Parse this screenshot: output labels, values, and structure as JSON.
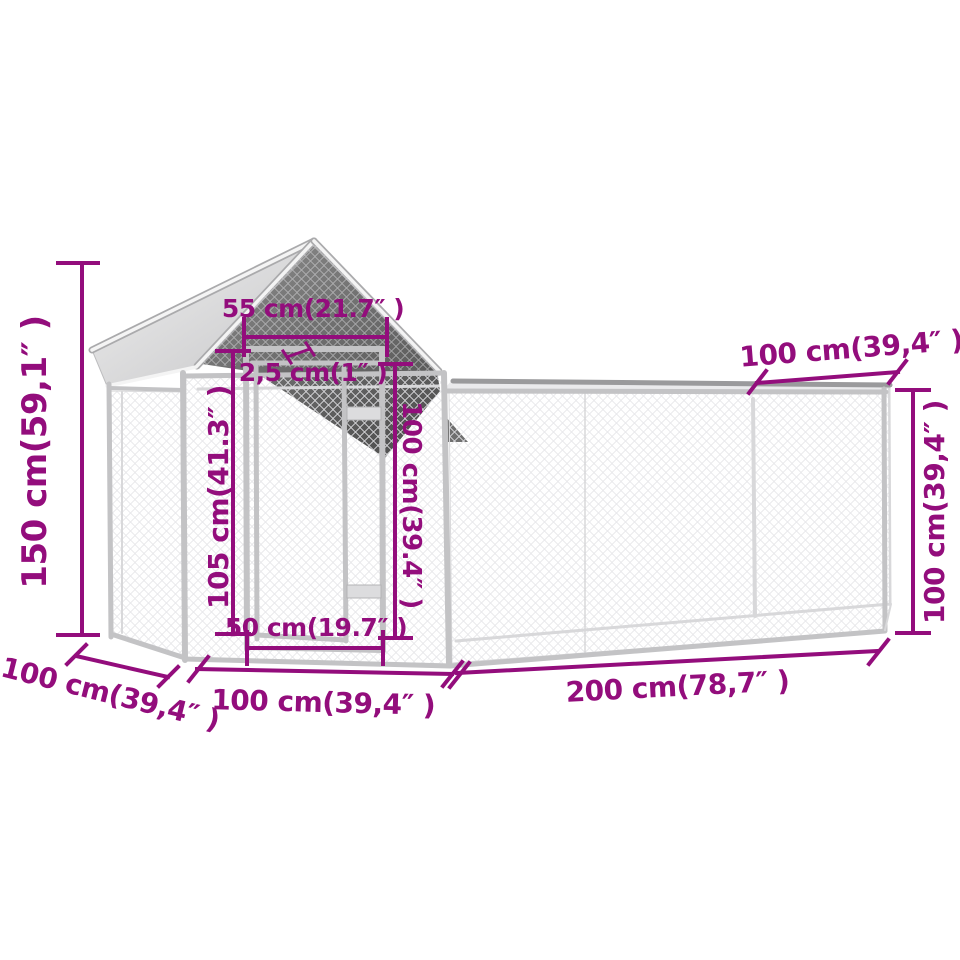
{
  "diagram": {
    "title": "chicken-coop-with-run-dimension-diagram",
    "accent_color": "#930d7c",
    "background": "#ffffff"
  },
  "dimensions": {
    "total_height": {
      "label": "150 cm(59,1″ )"
    },
    "coop_roof_width": {
      "label": "55 cm(21.7″ )"
    },
    "frame_tube": {
      "label": "2,5 cm(1″ )"
    },
    "door_height": {
      "label": "105 cm(41.3″ )"
    },
    "wall_height": {
      "label": "100 cm(39.4″ )"
    },
    "door_width": {
      "label": "50 cm(19.7″ )"
    },
    "run_depth": {
      "label": "100 cm(39,4″ )"
    },
    "run_height": {
      "label": "100 cm(39,4″ )"
    },
    "coop_depth": {
      "label": "100 cm(39,4″ )"
    },
    "coop_width": {
      "label": "100 cm(39,4″ )"
    },
    "run_length": {
      "label": "200 cm(78,7″ )"
    }
  }
}
